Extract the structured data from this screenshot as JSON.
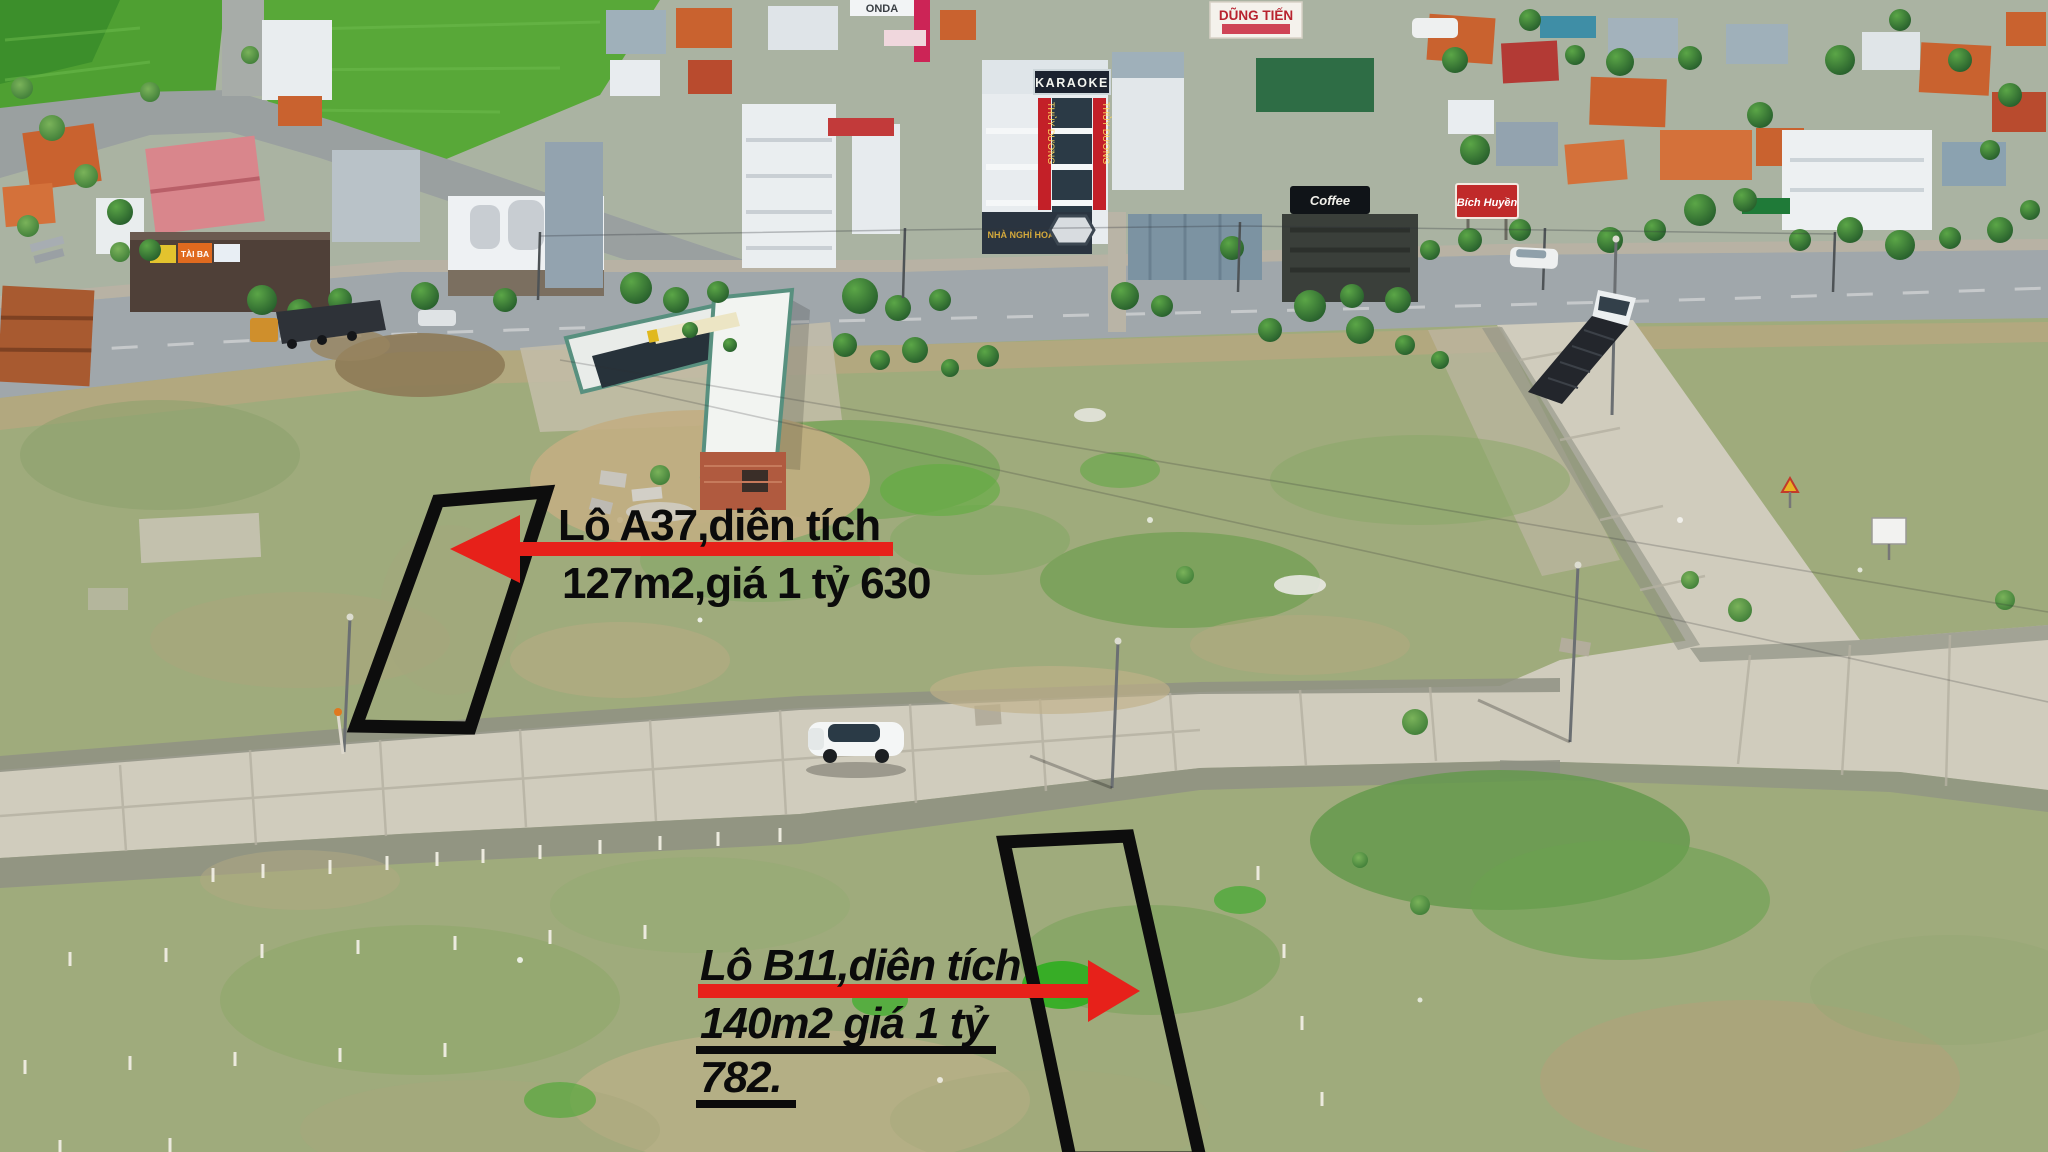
{
  "annotations": {
    "a37": {
      "line1": "Lô A37,diên tích",
      "line2": "127m2,giá 1 tỷ 630",
      "arrow_direction": "left"
    },
    "b11": {
      "line1": "Lô B11,diên tích",
      "line2": "140m2 giá 1 tỷ",
      "line3": "782.",
      "arrow_direction": "right"
    }
  },
  "signs": {
    "karaoke": "KARAOKE",
    "thuy_duong": "THỦY DƯƠNG",
    "guesthouse": "NHÀ NGHỈ HOÀNG GIA",
    "dung_tien": "DŨNG TIẾN",
    "honda": "ONDA",
    "coffee": "Coffee",
    "tai_ba": "TÀI BA",
    "bich_huyen": "Bích Huyền"
  },
  "objects": {
    "car": "white-suv",
    "truck_right": "covered-truck",
    "truck_left": "tipper-truck",
    "van": "white-van"
  },
  "colors": {
    "annotation_text": "#0b0b0b",
    "arrow_red": "#e7211a",
    "plot_outline": "#0d0d0d",
    "grass_field": "#9fab7c",
    "paddy_green": "#55a636",
    "concrete_road": "#d0ccbd",
    "highway_asphalt": "#a0a7ab"
  }
}
